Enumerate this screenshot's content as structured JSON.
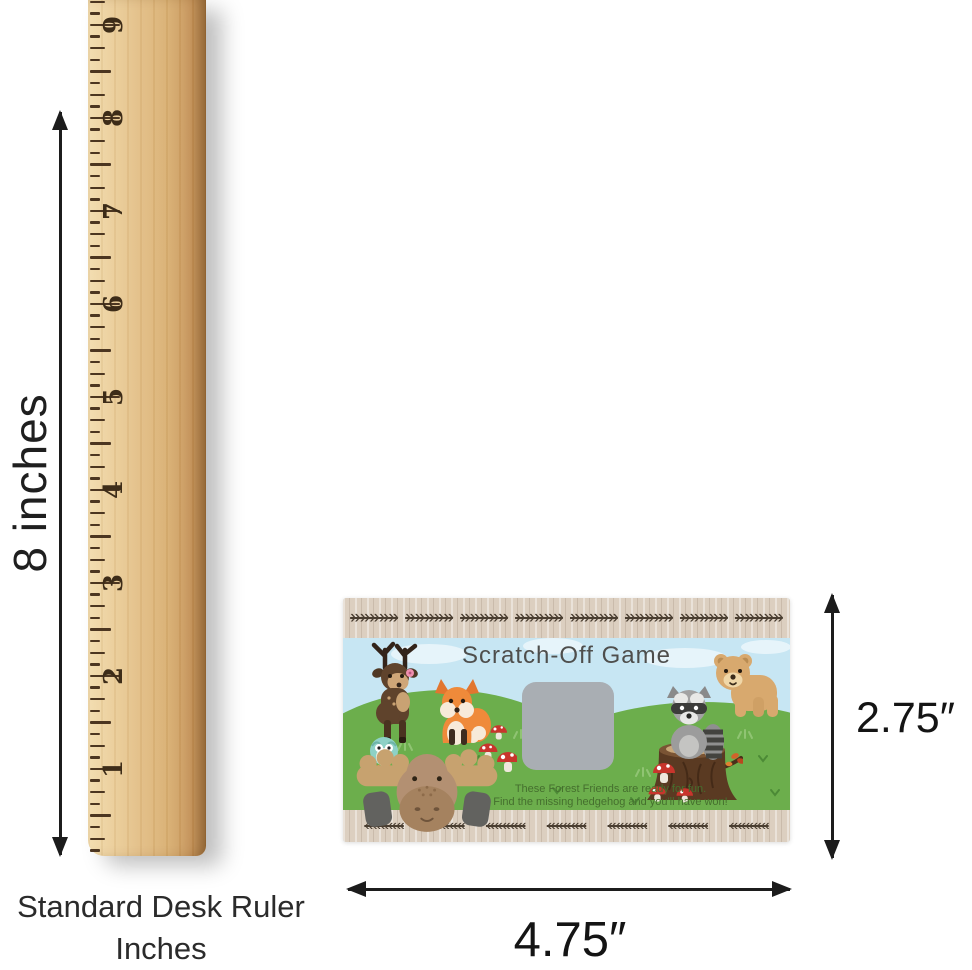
{
  "ruler": {
    "numbers": [
      "9",
      "8",
      "7",
      "6",
      "5",
      "4",
      "3",
      "2",
      "1"
    ],
    "caption_line1": "Standard Desk Ruler",
    "caption_line2": "Inches",
    "height_label": "8 inches"
  },
  "card": {
    "title": "Scratch-Off Game",
    "tagline_line1": "These Forest Friends are ready for fun.",
    "tagline_line2": "Find the missing hedgehog and you'll have won!",
    "width_label": "4.75″",
    "height_label": "2.75″",
    "border_motif_right": "»»»»»",
    "border_motif_left": "«««««",
    "motif_count_top": 8,
    "motif_count_bottom": 7
  },
  "icons": {
    "deer-icon": "woodland deer",
    "fox-icon": "fox",
    "owl-icon": "owl",
    "moose-icon": "moose peeking",
    "raccoon-icon": "raccoon on stump",
    "bear-icon": "bear cub",
    "stump-icon": "tree stump",
    "mushroom-icon": "red toadstool",
    "arrow-vertical-icon": "double headed vertical measurement arrow",
    "arrow-horizontal-icon": "double headed horizontal measurement arrow"
  },
  "colors": {
    "sky": "#c7e6f3",
    "grass": "#6cae4c",
    "wood_border": "#dccfc0",
    "border_pattern": "#4a3e31",
    "scratch_area": "#a9aeb3",
    "title_text": "#4e4e4c",
    "tagline_text": "#456f2e",
    "ruler_wood": "#e2bd84",
    "ruler_marks": "#4c3621",
    "annotation": "#1c1c1c"
  }
}
